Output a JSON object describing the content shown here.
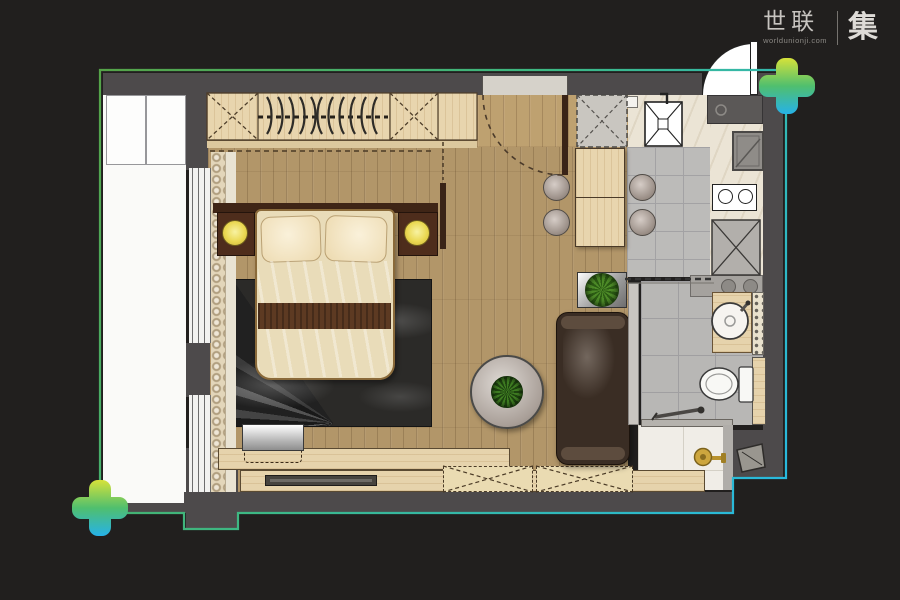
{
  "logo": {
    "brand_cn": "世联",
    "brand_url": "worldunionji.com",
    "brand_suffix": "集"
  },
  "palette": {
    "background": "#211f1e",
    "wall": "#4d4a4b",
    "outline_green": "#55a348",
    "outline_cyan": "#27b9e4",
    "marker_gradient": [
      "#d6e23a",
      "#50bf6e",
      "#26b2e8"
    ],
    "wood_floor": "#b29669",
    "cabinet_wood": "#e8d5ae",
    "tile_gray": "#bcbbb9",
    "marble_cream": "#ebe4d5",
    "bed_linen": "#f2e4c0",
    "bed_runner": "#5d3a22",
    "lamp_yellow": "#ead852",
    "plant_green": "#4e8c28",
    "fixture_gold": "#cda63e"
  },
  "objects": [
    "entry-door",
    "interior-door",
    "wardrobe",
    "clothes-hangers",
    "double-bed",
    "pillows",
    "bed-runner",
    "nightstand-left",
    "nightstand-right",
    "bedside-lamp",
    "area-rug",
    "balcony",
    "window",
    "curtain",
    "desk",
    "laptop",
    "desk-chair",
    "tv-board",
    "wall-tv",
    "storage-cabinets",
    "sofa",
    "planter",
    "coffee-table",
    "potted-plant",
    "dining-table",
    "dining-stools",
    "washing-machine-space",
    "kitchen-sink",
    "countertop",
    "cooktop",
    "refrigerator",
    "bathroom-sliding-door",
    "washbasin-vanity",
    "towel-shelf",
    "toilet",
    "shower-area",
    "shower-set",
    "floor-drain-gold",
    "bathroom-folding-door",
    "corner-marker-top-right",
    "corner-marker-bottom-left"
  ]
}
